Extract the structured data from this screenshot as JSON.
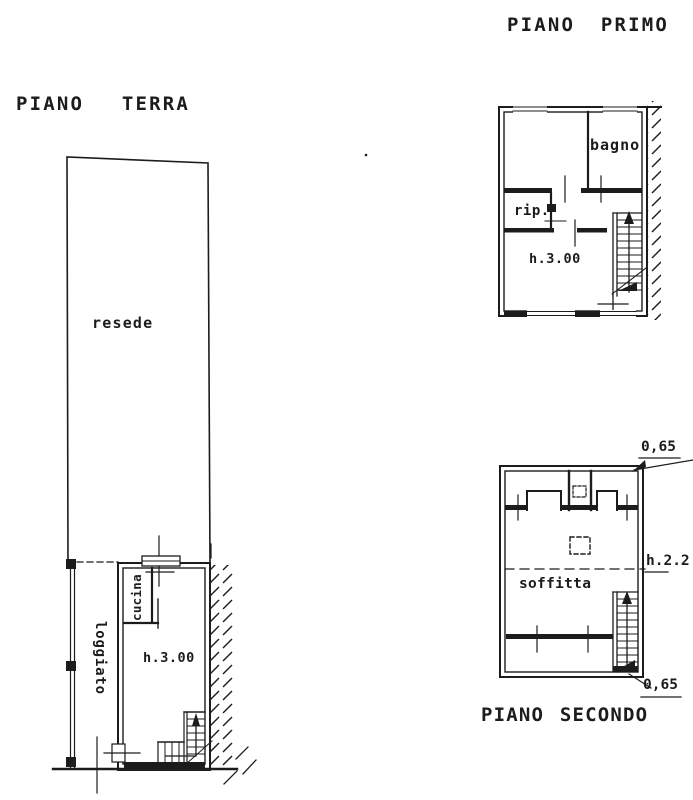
{
  "titles": {
    "ground_floor": "PIANO TERRA",
    "first_floor": "PIANO PRIMO",
    "second_floor": "PIANO SECONDO"
  },
  "ground_floor": {
    "plot_label": "resede",
    "porch_label": "loggiato",
    "kitchen_label": "cucina",
    "height_label": "h.3.00"
  },
  "first_floor": {
    "bathroom_label": "bagno",
    "storage_label": "rip.",
    "height_label": "h.3.00"
  },
  "second_floor": {
    "attic_label": "soffitta",
    "height_label": "h.2.2",
    "dimension_top": "0,65",
    "dimension_bottom": "0,65"
  },
  "colors": {
    "ink": "#1c1c1c",
    "paper": "#ffffff"
  }
}
